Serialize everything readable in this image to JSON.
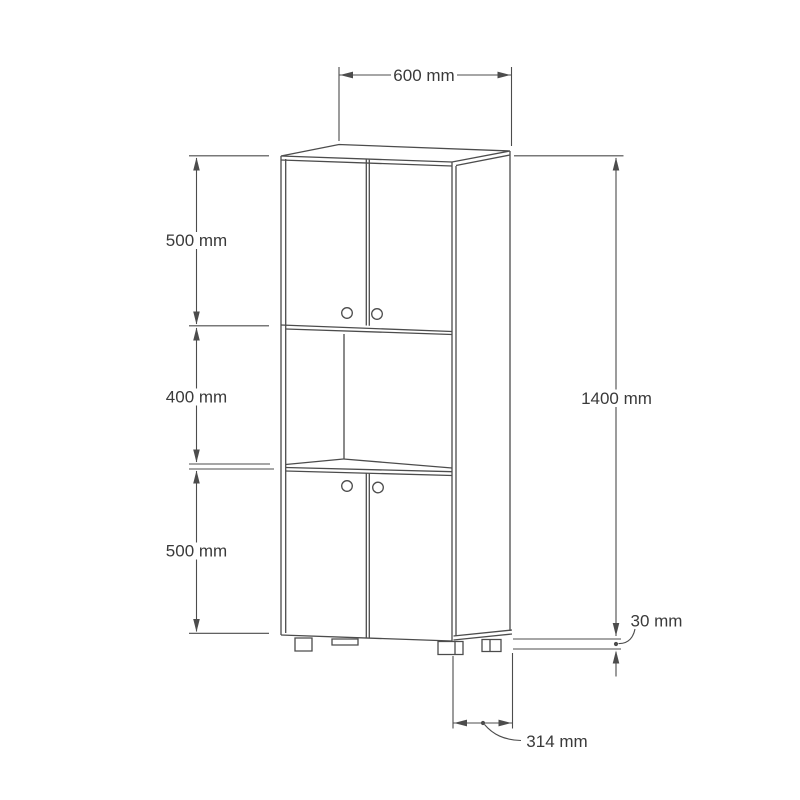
{
  "theme": {
    "background": "#ffffff",
    "line_color": "#4c4c4c",
    "text_color": "#3a3a3a"
  },
  "diagram": {
    "kind": "furniture-dimension-drawing",
    "subject": "tall cabinet with upper and lower double doors, open middle shelf and four feet",
    "unit": "mm",
    "labels": {
      "top_width": "600 mm",
      "upper_section": "500 mm",
      "middle_section": "400 mm",
      "lower_section": "500 mm",
      "total_height": "1400 mm",
      "foot_height": "30 mm",
      "depth": "314 mm"
    },
    "values_mm": {
      "width": 600,
      "upper_section_height": 500,
      "middle_section_height": 400,
      "lower_section_height": 500,
      "total_height": 1400,
      "foot_height": 30,
      "depth": 314
    }
  }
}
